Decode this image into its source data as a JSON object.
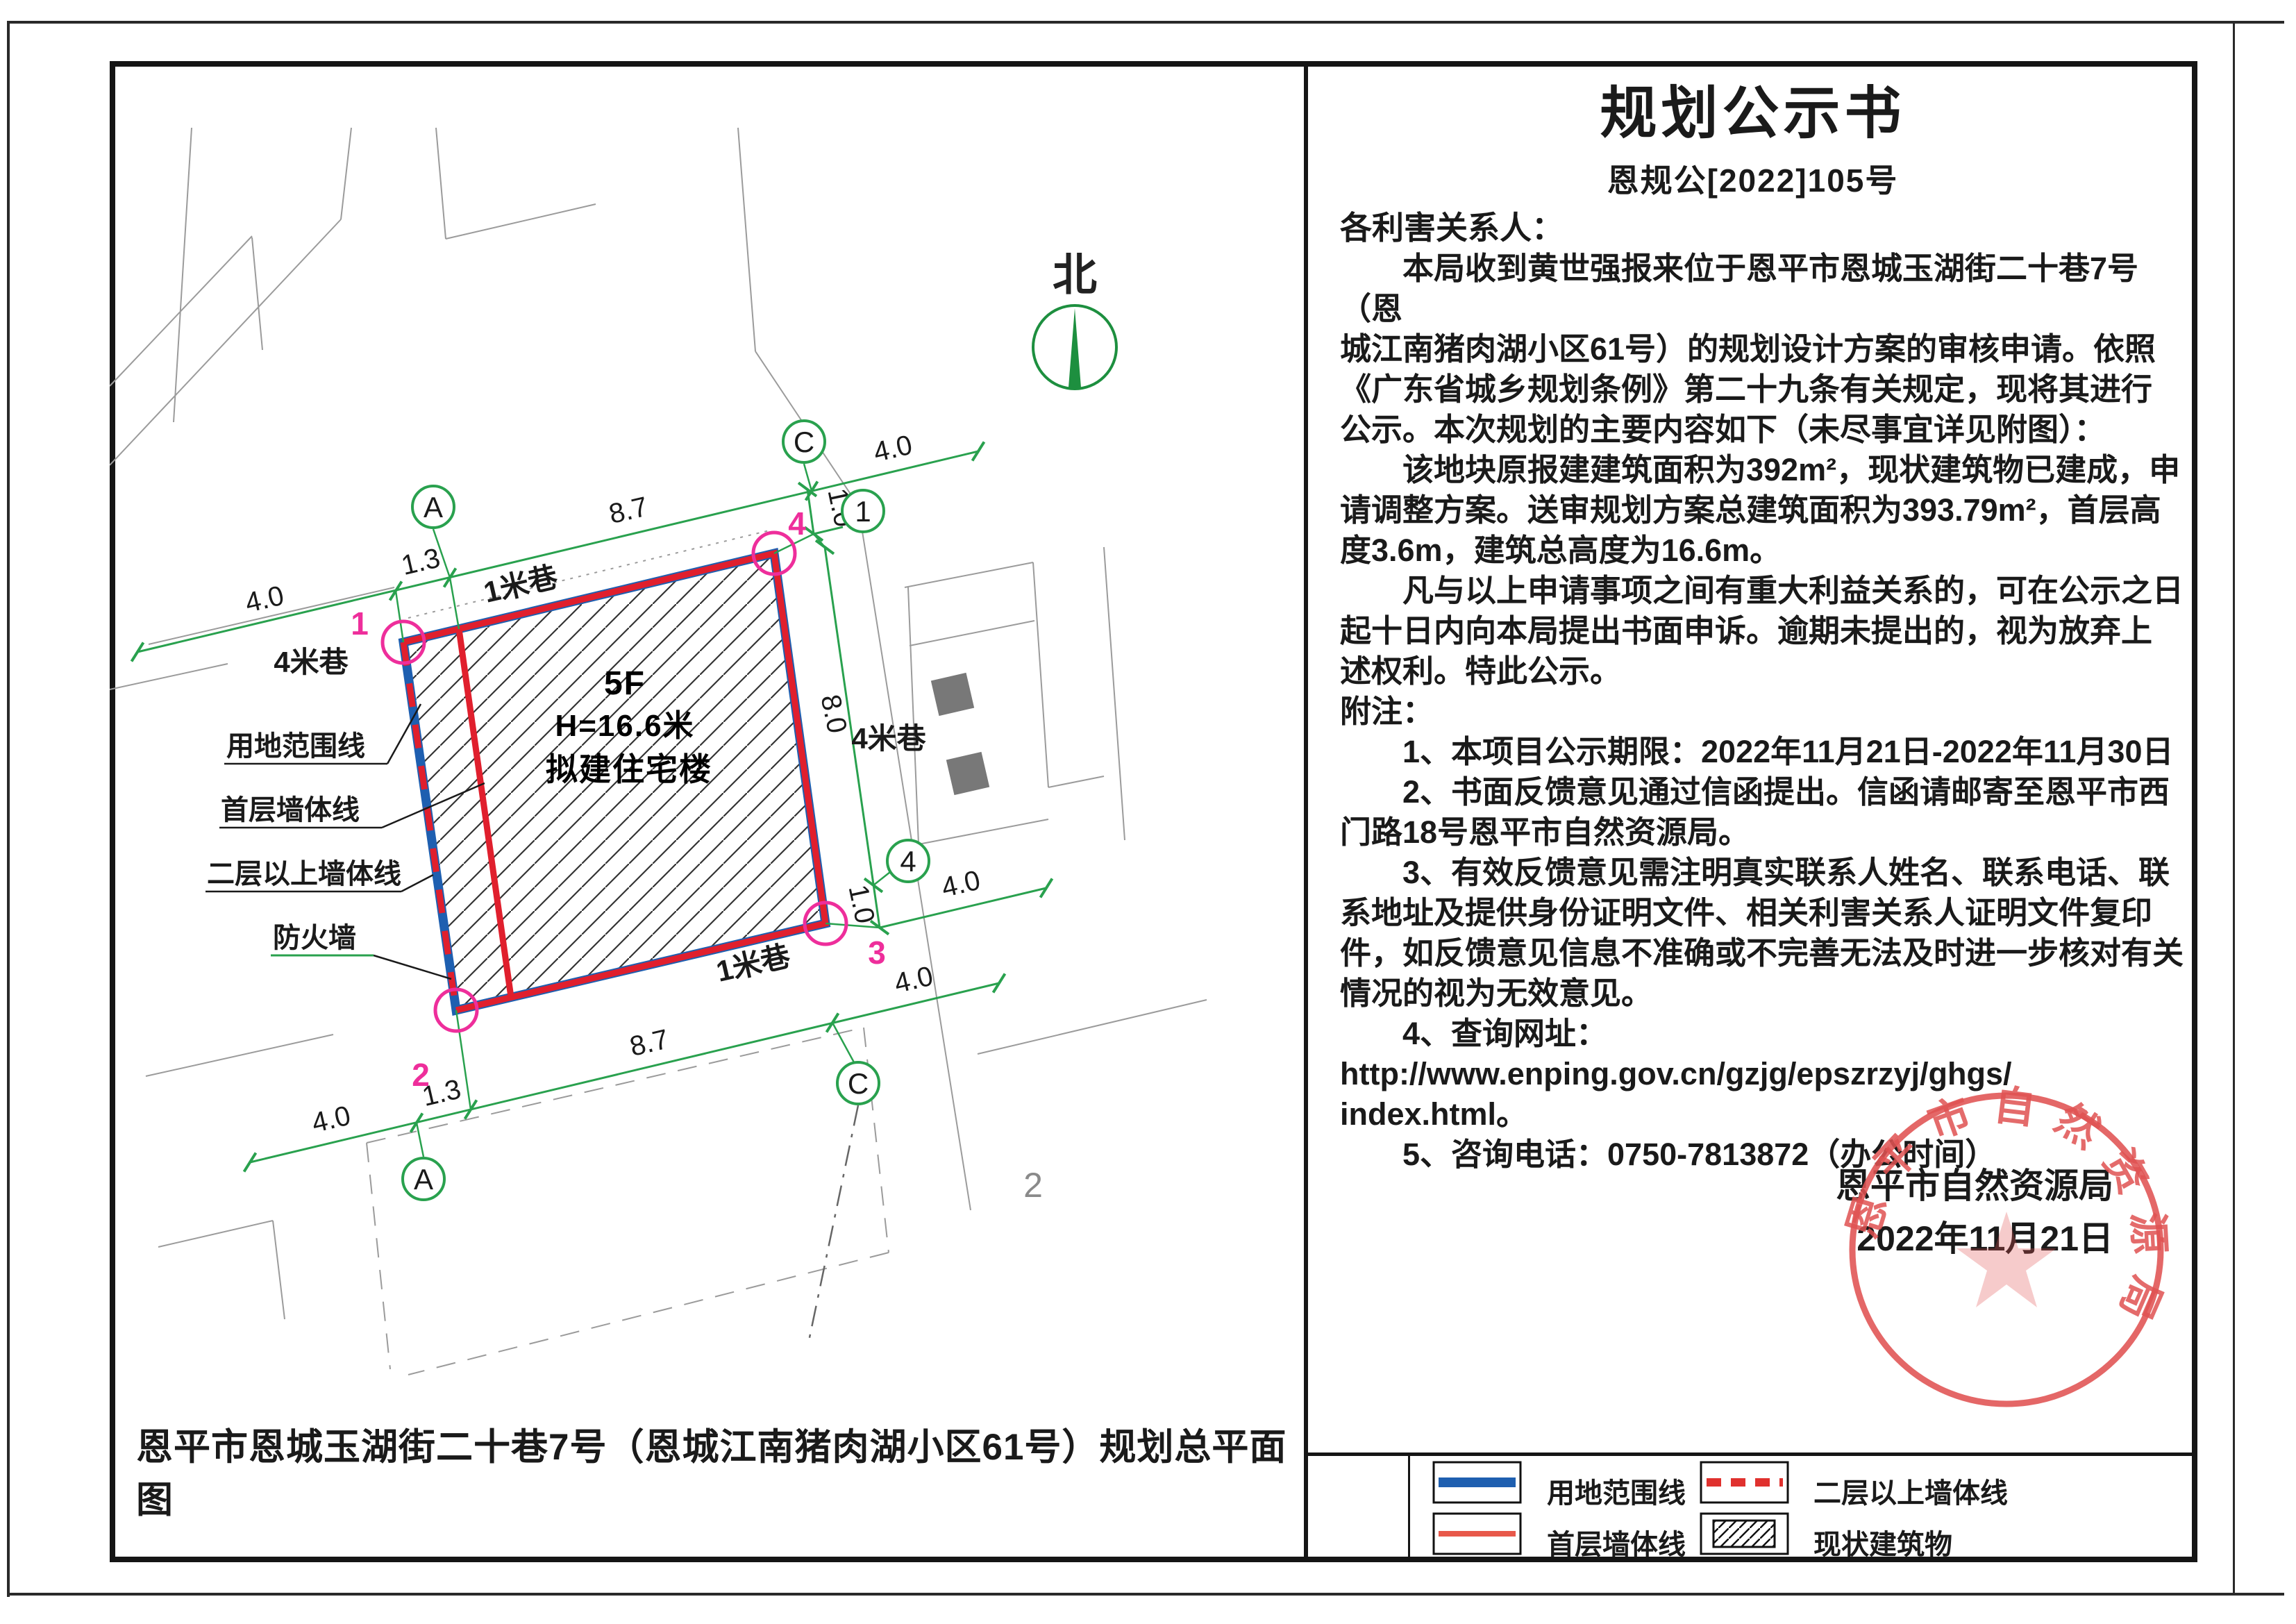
{
  "notice": {
    "title": "规划公示书",
    "doc_no": "恩规公[2022]105号",
    "salutation": "各利害关系人：",
    "body_lines": [
      "　　本局收到黄世强报来位于恩平市恩城玉湖街二十巷7号（恩",
      "城江南猪肉湖小区61号）的规划设计方案的审核申请。依照",
      "《广东省城乡规划条例》第二十九条有关规定，现将其进行",
      "公示。本次规划的主要内容如下（未尽事宜详见附图）：",
      "　　该地块原报建建筑面积为392m²，现状建筑物已建成，申",
      "请调整方案。送审规划方案总建筑面积为393.79m²，首层高",
      "度3.6m，建筑总高度为16.6m。",
      "　　凡与以上申请事项之间有重大利益关系的，可在公示之日",
      "起十日内向本局提出书面申诉。逾期未提出的，视为放弃上",
      "述权利。特此公示。",
      "附注：",
      "　　1、本项目公示期限：2022年11月21日-2022年11月30日",
      "　　2、书面反馈意见通过信函提出。信函请邮寄至恩平市西",
      "门路18号恩平市自然资源局。",
      "　　3、有效反馈意见需注明真实联系人姓名、联系电话、联",
      "系地址及提供身份证明文件、相关利害关系人证明文件复印",
      "件，如反馈意见信息不准确或不完善无法及时进一步核对有关",
      "情况的视为无效意见。",
      "　　4、查询网址：",
      "http://www.enping.gov.cn/gzjg/epszrzyj/ghgs/",
      "index.html。",
      "　　5、咨询电话：0750-7813872（办公时间）"
    ],
    "agency": "恩平市自然资源局",
    "date": "2022年11月21日"
  },
  "plan": {
    "caption": "恩平市恩城玉湖街二十巷7号（恩城江南猪肉湖小区61号）规划总平面图",
    "north_label": "北",
    "roads": {
      "top": "1米巷",
      "left": "4米巷",
      "right": "4米巷",
      "bottom": "1米巷"
    },
    "building": {
      "floors": "5F",
      "height": "H=16.6米",
      "name": "拟建住宅楼"
    },
    "axes": {
      "a": "A",
      "c": "C",
      "n1": "1",
      "n4": "4"
    },
    "corner_points": [
      "1",
      "2",
      "3",
      "4"
    ],
    "dims": {
      "top_left": "4.0",
      "top_offset": "1.3",
      "top_width": "8.7",
      "top_right": "4.0",
      "top_gap": "1.0",
      "right_depth": "8.0",
      "right_gap": "1.0",
      "right_out": "4.0",
      "bottom_width": "8.7",
      "bottom_out": "4.0",
      "bottom_offset": "1.3",
      "bottom_left": "4.0"
    },
    "leader_labels": [
      "用地范围线",
      "首层墙体线",
      "二层以上墙体线",
      "防火墙"
    ],
    "parcel_mark": "2"
  },
  "legend": {
    "items": [
      {
        "label": "用地范围线",
        "type": "blue-solid"
      },
      {
        "label": "二层以上墙体线",
        "type": "red-dashed"
      },
      {
        "label": "首层墙体线",
        "type": "red-solid"
      },
      {
        "label": "现状建筑物",
        "type": "hatched"
      }
    ]
  },
  "stamp": {
    "text": "恩平市自然资源局"
  },
  "colors": {
    "dim_green": "#29a14e",
    "wall_red": "#e01f2d",
    "boundary_blue": "#1e5fb0",
    "corner_magenta": "#ee2e9b",
    "stamp_red": "#e05252"
  }
}
